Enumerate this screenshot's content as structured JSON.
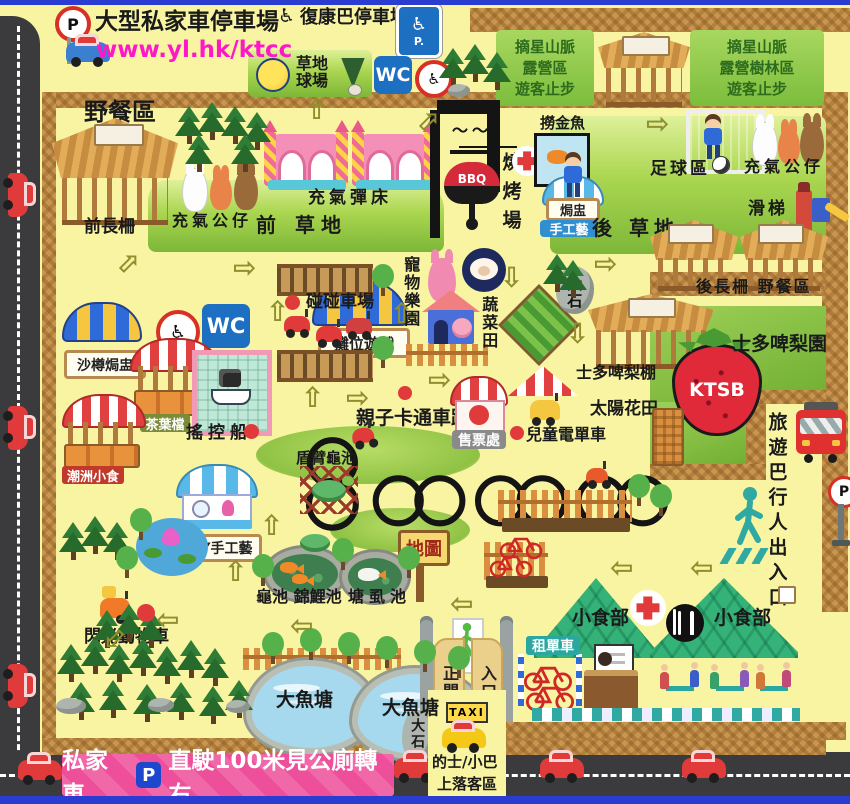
{
  "icons": {
    "wheelchair": "♿",
    "arrow_up": "⇧",
    "arrow_down": "⇩",
    "arrow_left": "⇦",
    "arrow_right": "⇨"
  },
  "colors": {
    "banner_pink": "#ee4f9a",
    "url_magenta": "#ff18c8",
    "sign_blue": "#1d6fc2",
    "tent_green": "#35b278",
    "road": "#3b3b3d",
    "wicker": "#c8964f"
  },
  "header": {
    "p_sign": "P",
    "car_park_title": "大型私家車停車場",
    "url": "www.yl.hk/ktcc",
    "rehab_bus_park": "復康巴停車場",
    "accessible_parking": "P.",
    "grass_court_line1": "草地",
    "grass_court_line2": "球場",
    "wc": "WC",
    "camp_zone_a": [
      "摘星山脈",
      "露營區",
      "遊客止步"
    ],
    "camp_zone_b": [
      "摘星山脈",
      "露營樹林區",
      "遊客止步"
    ]
  },
  "west": {
    "picnic_area": "野餐區",
    "front_shed": "前長柵",
    "inflatable_dolls": "充氣公仔",
    "bouncy_trampoline": "充氣彈床",
    "front_lawn": "前 草地",
    "sand_jar_pottery": "沙樽焗盅",
    "tea_leaf_stall": "茶葉檔",
    "rc_boat": "搖控船",
    "chiuchow_snacks": "潮洲小食",
    "diy_handicraft": "DIY手工藝",
    "flash_animal_car": "閃光動物車"
  },
  "bbq": {
    "site_vertical": "燒烤場",
    "grill": "BBQ",
    "goldfish_scooping": "撈金魚",
    "pot_stewing": "焗盅",
    "handicraft": "手工藝"
  },
  "east": {
    "soccer_zone": "足球區",
    "inflatable_dolls": "充氣公仔",
    "slide": "滑梯",
    "back_lawn": "後 草地",
    "back_shed_picnic": "後長柵 野餐區",
    "strawberry_shed": "士多啤梨棚",
    "strawberry_garden": "士多啤梨園",
    "strawberry_logo": "KTSB"
  },
  "mid": {
    "wc": "WC",
    "booth_games": "攤位遊戲",
    "bumper_car_zone": "碰碰車場",
    "pet_paradise": "寵物樂園",
    "vegetable_field": "蔬菜田",
    "big_rock": "大石",
    "cartoon_kart_track": "親子卡通車跑道",
    "ticket_office": "售票處",
    "kids_motorbike": "兒童電單車",
    "sunflower_field": "太陽花田",
    "tortoise_pond": "盾臂龜池",
    "map_sign": "地圖",
    "turtle_koi_ponds": "龜池 錦鯉池",
    "catfish_pond": "塘虱池"
  },
  "right": {
    "tour_bus_pedestrian_exit": "旅遊巴行人出入口",
    "p_sign": "P"
  },
  "south": {
    "big_fish_pond_1": "大魚塘",
    "big_fish_pond_2": "大魚塘",
    "main_gate": "正門",
    "entrance": "入口",
    "big_rock": "大石",
    "taxi_sign": "TAXI",
    "taxi_zone_line1": "的士/小巴",
    "taxi_zone_line2": "上落客區",
    "bike_rental": "租單車",
    "snack_bar_1": "小食部",
    "snack_bar_2": "小食部"
  },
  "banner": {
    "private_car": "私家車",
    "p_badge": "P",
    "instruction": "直駛100米見公廁轉右"
  }
}
